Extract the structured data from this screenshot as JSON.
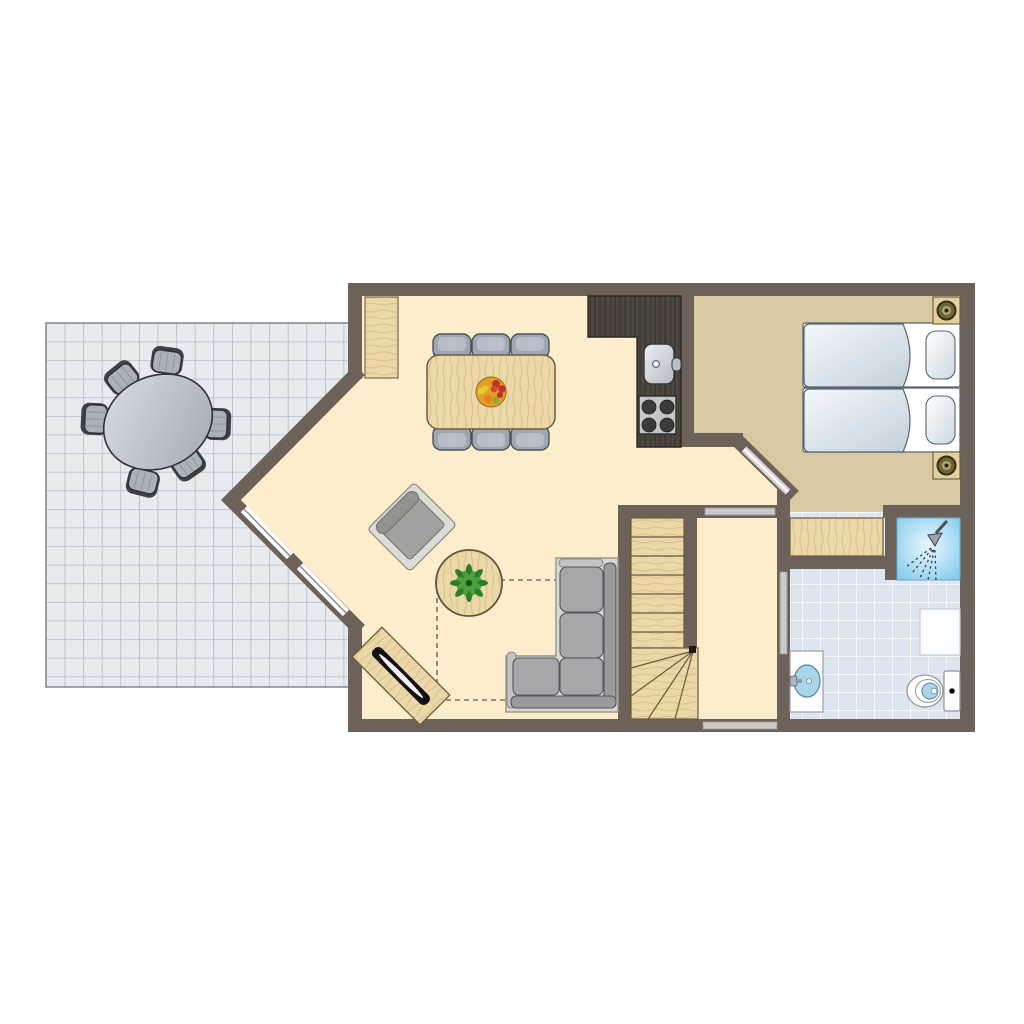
{
  "meta": {
    "type": "floor-plan",
    "floor": "ground-floor-holiday-home"
  },
  "colors": {
    "wall": "#6c6259",
    "living_floor": "#fceecd",
    "bedroom_floor": "#d7c9a1",
    "terrace_tile": "#e7eaee",
    "terrace_grid": "#a9b2bb",
    "bath_tile": "#dee5ef",
    "wood_light": "#ebd8a9",
    "wood_grain": "#d3b57c",
    "wood_dark": "#46403a",
    "sofa_gray": "#a6a7a9",
    "chair_gray": "#9fa8b2",
    "terrace_chair_gray": "#aab1b8",
    "shower_blue": "#7cc7ea",
    "water_blue": "#a9d6ea",
    "door_gray": "#c9c9c9",
    "dash_line": "#7d7263",
    "plant_green": "#2f7d2c",
    "bed_white": "#ffffff"
  },
  "rooms": {
    "terrace": {
      "furniture_counts": {
        "oval_table": 1,
        "chairs": 6
      }
    },
    "living_room": {
      "furniture_counts": {
        "dining_table": 1,
        "dining_chairs": 6,
        "fruit_bowl": 1,
        "sideboard": 1,
        "armchair": 1,
        "coffee_table": 1,
        "plant": 1,
        "tv_stand": 1,
        "tv": 1,
        "corner_sofa": 1
      }
    },
    "kitchen": {
      "furniture_counts": {
        "counter": 1,
        "sink": 1,
        "stove": 1,
        "burners": 4
      }
    },
    "bedroom": {
      "furniture_counts": {
        "single_beds": 2,
        "pillows": 2,
        "nightstands": 2,
        "lamps": 2,
        "wardrobe": 1
      }
    },
    "bathroom": {
      "furniture_counts": {
        "shower": 1,
        "washbasin": 1,
        "toilet": 1,
        "shelf": 1
      }
    },
    "hallway": {
      "furniture_counts": {
        "doors": 3
      }
    },
    "staircase": {
      "furniture_counts": {
        "straight_treads": 7,
        "winder_treads": 5
      }
    }
  }
}
